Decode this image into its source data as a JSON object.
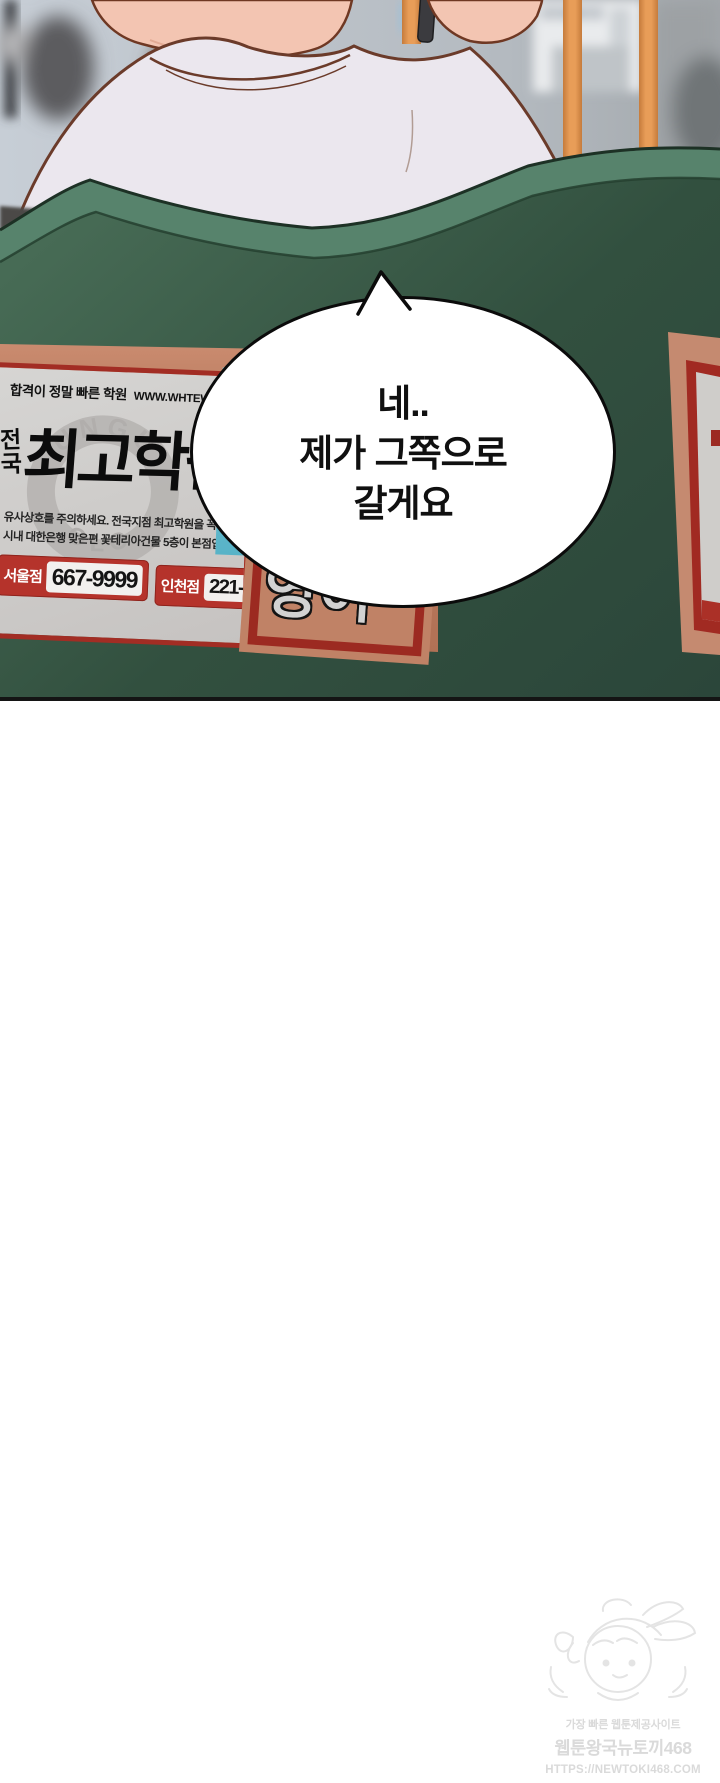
{
  "panel": {
    "bubble": {
      "lines": [
        "네..",
        "제가 그쪽으로",
        "갈게요"
      ]
    },
    "poster": {
      "tagline": "합격이 정말 빠른 학원",
      "website": "WWW.WHTEWKOSI.COM",
      "logo_arc_top": "UNGU",
      "logo_arc_bottom": "OLO",
      "title_prefix_chars": [
        "전",
        "국"
      ],
      "title": "최고학원",
      "notice_lines": [
        "유사상호를 주의하세요. 전국지점 최고학원을 꼭 확인하세",
        "시내 대한은행 맞은편 꽃테리아건물 5층이 본점입니다."
      ],
      "branches": [
        {
          "name": "서울점",
          "phone": "667-9999"
        },
        {
          "name": "인천점",
          "phone": "221-1110"
        }
      ]
    },
    "seat_ad_text": "영어",
    "colors": {
      "seat_green_light": "#57836c",
      "seat_green": "#3c5d4a",
      "seat_green_dark": "#2c473a",
      "board_salmon": "#bf8165",
      "poster_red": "#a22d24",
      "phone_box_red": "#b5332b",
      "poster_gray": "#d0cecc",
      "cyan_strip": "#6fc3d6",
      "pole_orange": "#e89d58",
      "panel_border": "#141414"
    }
  },
  "watermark": {
    "line1": "가장 빠른 웹툰제공사이트",
    "line2": "웹툰왕국뉴토끼468",
    "line3": "HTTPS://NEWTOKI468.COM"
  }
}
